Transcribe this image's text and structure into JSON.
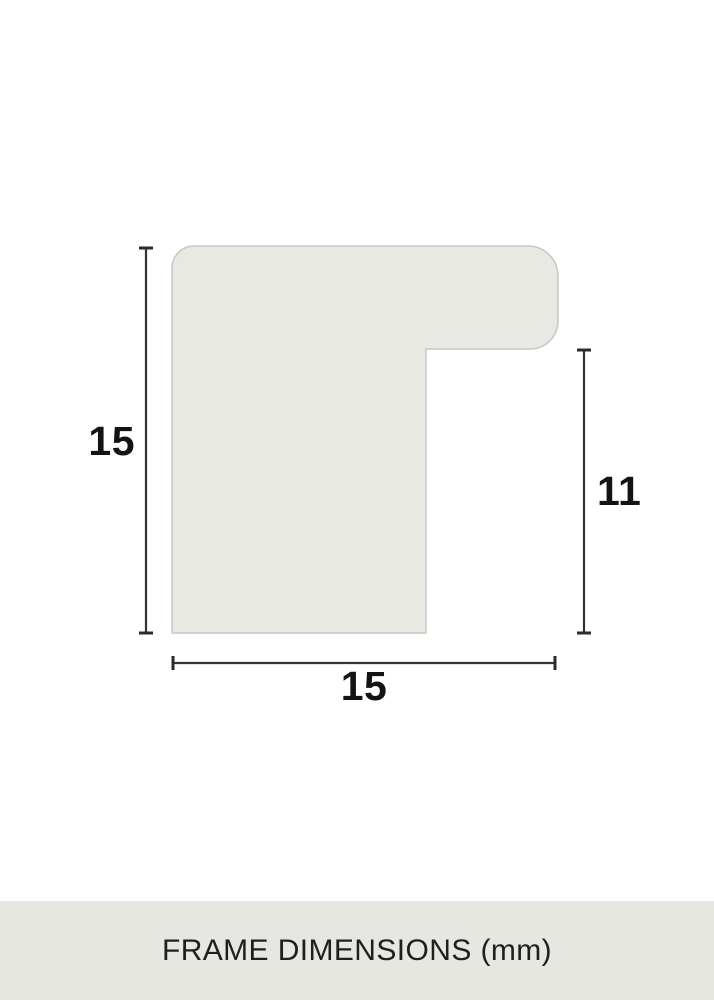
{
  "diagram": {
    "type": "frame-profile-cross-section",
    "labels": {
      "profile_height_mm": "15",
      "rabbet_height_mm": "11",
      "profile_width_mm": "15"
    }
  },
  "footer": {
    "caption": "FRAME DIMENSIONS (mm)"
  },
  "colors": {
    "canvas_bg": "#ffffff",
    "profile_fill": "#e9e9e4",
    "profile_stroke": "#c7c7c2",
    "dimension_line": "#333333",
    "label_text": "#141414",
    "footer_bg": "#e7e7e2",
    "footer_text": "#1f1f1f"
  }
}
